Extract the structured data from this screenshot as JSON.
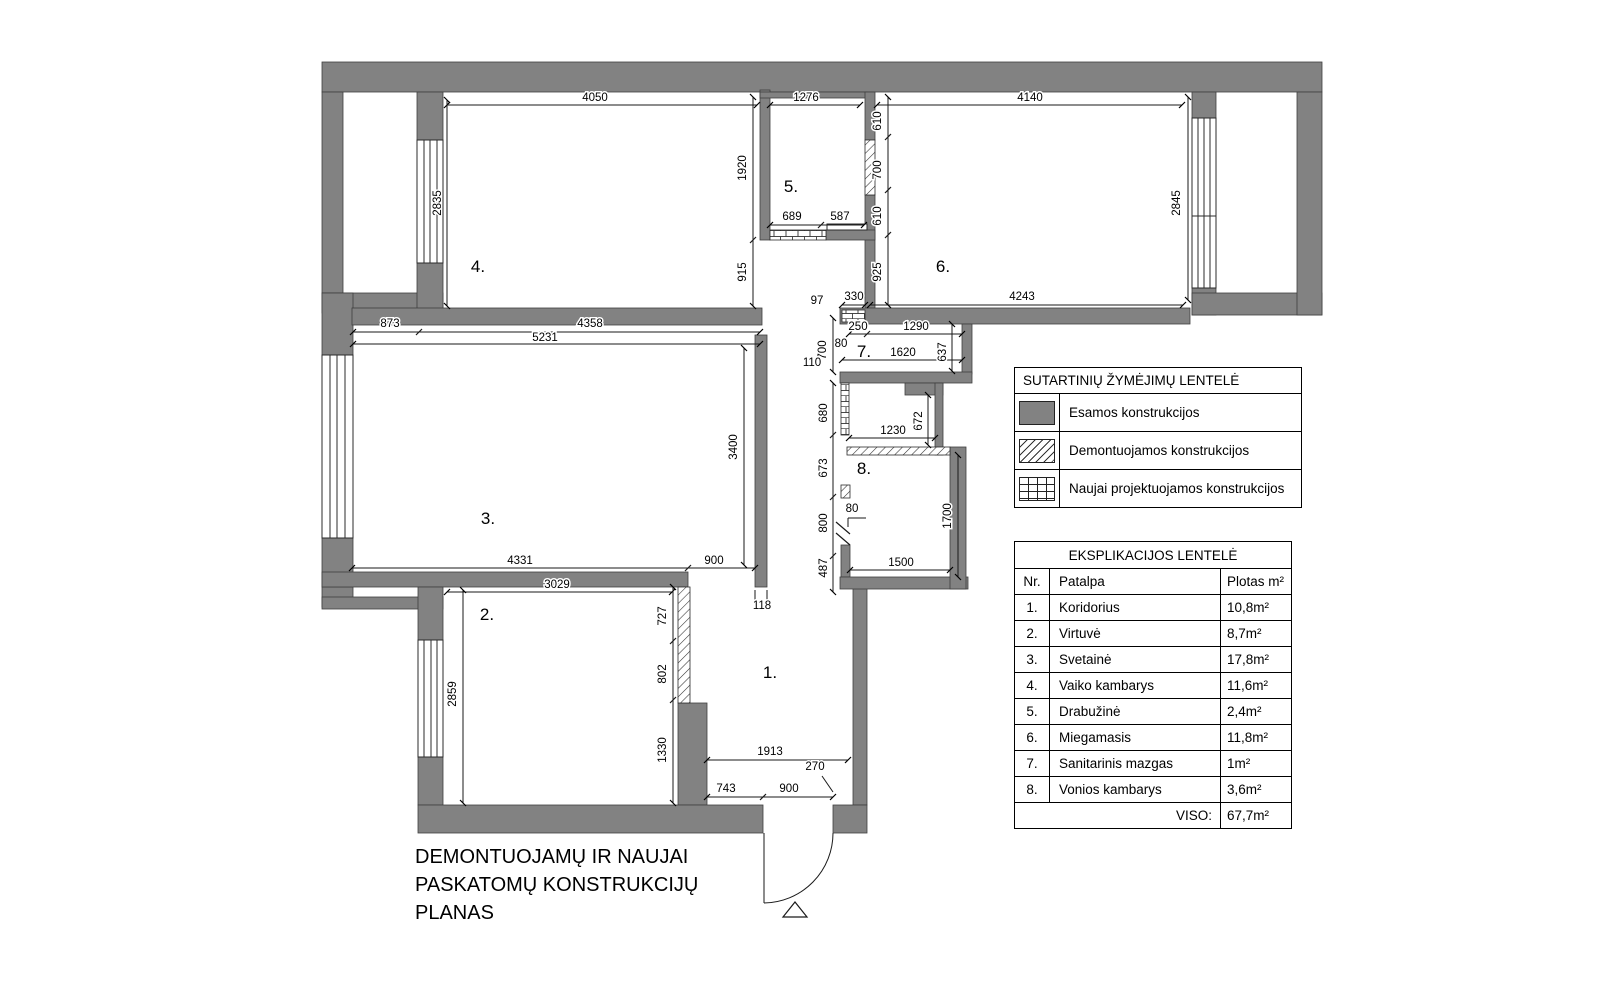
{
  "title_block": {
    "line1": "DEMONTUOJAMŲ IR NAUJAI",
    "line2": "PASKATOMŲ KONSTRUKCIJŲ",
    "line3": "PLANAS"
  },
  "legend": {
    "title": "SUTARTINIŲ ŽYMĖJIMŲ LENTELĖ",
    "items": [
      {
        "swatch": "solid-gray",
        "label": "Esamos konstrukcijos"
      },
      {
        "swatch": "diagonal-hatch",
        "label": "Demontuojamos konstrukcijos"
      },
      {
        "swatch": "brick",
        "label": "Naujai projektuojamos konstrukcijos"
      }
    ]
  },
  "explication": {
    "title": "EKSPLIKACIJOS LENTELĖ",
    "headers": {
      "nr": "Nr.",
      "room": "Patalpa",
      "area": "Plotas m²"
    },
    "rows": [
      {
        "nr": "1.",
        "name": "Koridorius",
        "area": "10,8m²"
      },
      {
        "nr": "2.",
        "name": "Virtuvė",
        "area": "8,7m²"
      },
      {
        "nr": "3.",
        "name": "Svetainė",
        "area": "17,8m²"
      },
      {
        "nr": "4.",
        "name": "Vaiko kambarys",
        "area": "11,6m²"
      },
      {
        "nr": "5.",
        "name": "Drabužinė",
        "area": "2,4m²"
      },
      {
        "nr": "6.",
        "name": "Miegamasis",
        "area": "11,8m²"
      },
      {
        "nr": "7.",
        "name": "Sanitarinis mazgas",
        "area": "1m²"
      },
      {
        "nr": "8.",
        "name": "Vonios kambarys",
        "area": "3,6m²"
      }
    ],
    "total_label": "VISO:",
    "total_value": "67,7m²"
  },
  "plan": {
    "rooms": {
      "n1": "1.",
      "n2": "2.",
      "n3": "3.",
      "n4": "4.",
      "n5": "5.",
      "n6": "6.",
      "n7": "7.",
      "n8": "8."
    },
    "dims": {
      "w4050": "4050",
      "w1276": "1276",
      "w4140": "4140",
      "h2835": "2835",
      "v1920": "1920",
      "v915": "915",
      "b689": "689",
      "b587": "587",
      "c610a": "610",
      "c700": "700",
      "c610b": "610",
      "c925": "925",
      "h2845": "2845",
      "b4243": "4243",
      "d873": "873",
      "d4358": "4358",
      "d5231": "5231",
      "v3400": "3400",
      "d4331": "4331",
      "d900a": "900",
      "d3029": "3029",
      "v727": "727",
      "v802": "802",
      "v1330": "1330",
      "v2859": "2859",
      "d118": "118",
      "d1913": "1913",
      "d743": "743",
      "d900b": "900",
      "d270": "270",
      "d97": "97",
      "d330": "330",
      "d250": "250",
      "d1290": "1290",
      "v637": "637",
      "d80a": "80",
      "v700b": "700",
      "d1620": "1620",
      "d110": "110",
      "v680": "680",
      "v672": "672",
      "d1230": "1230",
      "v673": "673",
      "v800": "800",
      "d80b": "80",
      "v1700": "1700",
      "v487": "487",
      "d1500": "1500"
    }
  },
  "colors": {
    "wall_gray": "#828282",
    "line": "#000000"
  }
}
